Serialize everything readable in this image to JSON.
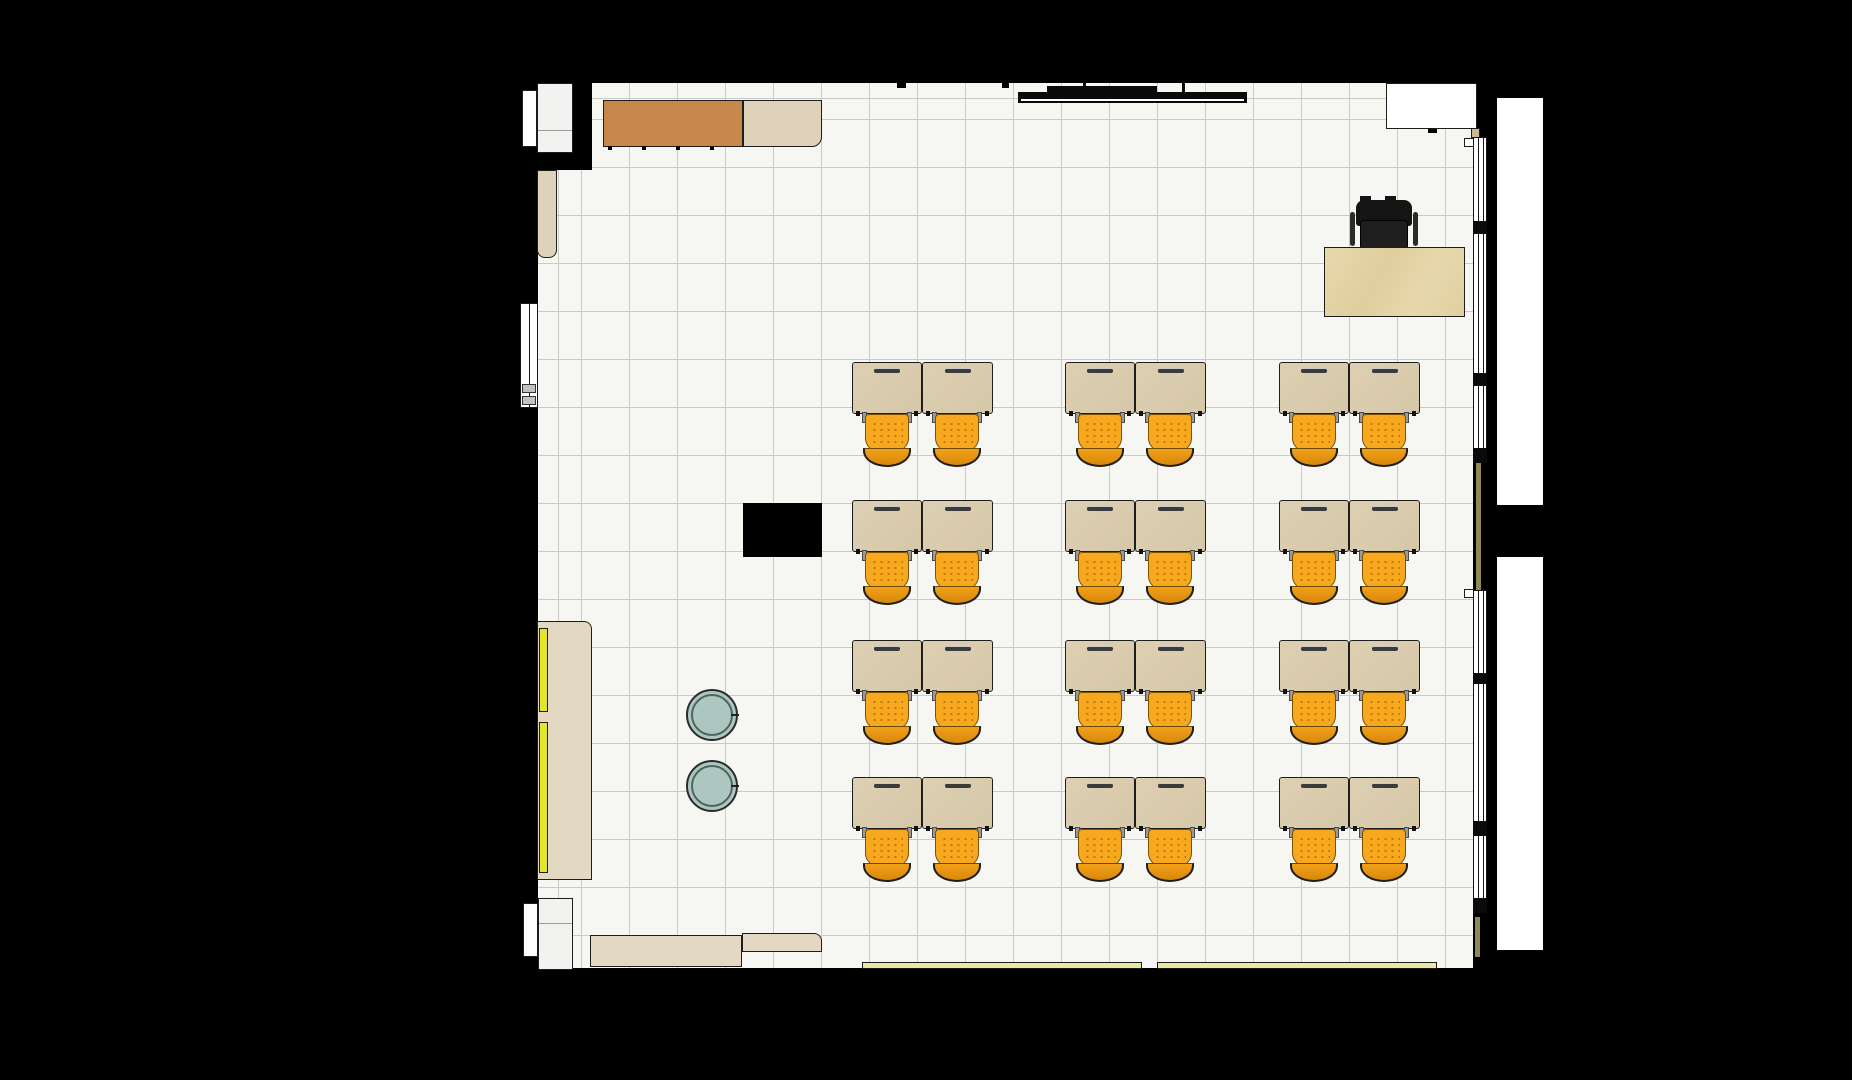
{
  "scene": {
    "width": 1852,
    "height": 1080,
    "background": "#000000",
    "description": "top-down classroom floor plan render"
  },
  "palette": {
    "wall": "#000000",
    "floor": "#F6F6F3",
    "grid_line": "#CBCBC6",
    "line": "#1d1d1d",
    "desk_wood": "#DBCEAF",
    "cabinet_brown": "#C8874A",
    "cabinet_tan": "#DFD2BA",
    "cabinet_light": "#E3D8C2",
    "teacher_desk_wood": "#E7D8AC",
    "chair_orange": "#F7A81F",
    "chair_orange_dark": "#D8880A",
    "stool_teal": "#AEC6C0",
    "door_white": "#FFFFFF",
    "recess_white": "#F2F2F0",
    "strip_yellow": "#E3E52C",
    "strip_pale_yellow": "#ECE6A4",
    "strip_khaki": "#8F8A55",
    "hardware_gray": "#C2C2C2",
    "hinge_tan": "#C9B98F",
    "chair_black": "#141414"
  },
  "floor": {
    "x": 538,
    "y": 83,
    "w": 935,
    "h": 885,
    "tile_px": 48,
    "wall_patch_top_left": {
      "x": 538,
      "y": 83,
      "w": 54,
      "h": 87
    }
  },
  "furniture": {
    "student_desks": {
      "label": "double student desk with two orange chairs",
      "cols_x": [
        852,
        1065,
        1279
      ],
      "rows_y": [
        362,
        500,
        640,
        777
      ],
      "pair_w": 141,
      "desk_w": 70,
      "desk_h": 52,
      "chair_w": 48,
      "chair_h": 53,
      "chair_centers": [
        35,
        105
      ]
    },
    "teacher_desk": {
      "x": 1324,
      "y": 247,
      "w": 141,
      "h": 70
    },
    "teacher_chair": {
      "x": 1350,
      "y": 200,
      "w": 68,
      "h": 50
    },
    "stools": [
      {
        "x": 686,
        "y": 689,
        "d": 52
      },
      {
        "x": 686,
        "y": 760,
        "d": 52
      }
    ],
    "shapes": [
      {
        "name": "wall-column-block",
        "x": 743,
        "y": 503,
        "w": 79,
        "h": 54,
        "fill": "wall"
      },
      {
        "name": "cabinet-top-brown",
        "x": 603,
        "y": 100,
        "w": 140,
        "h": 47,
        "fill": "cabinet_brown",
        "border": true
      },
      {
        "name": "cabinet-top-tan",
        "x": 743,
        "y": 100,
        "w": 79,
        "h": 47,
        "fill": "cabinet_tan",
        "border": true,
        "radius": "0 0 10px 0"
      },
      {
        "name": "cabinet-left-upper",
        "x": 537,
        "y": 170,
        "w": 20,
        "h": 88,
        "fill": "cabinet_tan",
        "border": true,
        "radius": "0 0 8px 8px"
      },
      {
        "name": "cabinet-left-lower",
        "x": 537,
        "y": 621,
        "w": 55,
        "h": 259,
        "fill": "cabinet_light",
        "border": true,
        "radius": "0 8px 0 0"
      },
      {
        "name": "cabinet-door-strip",
        "x": 539,
        "y": 628,
        "w": 9,
        "h": 84,
        "fill": "strip_yellow",
        "border": true
      },
      {
        "name": "cabinet-door-strip",
        "x": 539,
        "y": 722,
        "w": 9,
        "h": 151,
        "fill": "strip_yellow",
        "border": true
      },
      {
        "name": "cabinet-bottom-left",
        "x": 590,
        "y": 935,
        "w": 152,
        "h": 32,
        "fill": "cabinet_light",
        "border": true
      },
      {
        "name": "cabinet-bottom-rounded",
        "x": 742,
        "y": 933,
        "w": 80,
        "h": 19,
        "fill": "cabinet_light",
        "border": true,
        "radius": "0 8px 0 0"
      },
      {
        "name": "bottom-wall-board-strip",
        "x": 862,
        "y": 962,
        "w": 280,
        "h": 7,
        "fill": "strip_pale_yellow",
        "border": true
      },
      {
        "name": "bottom-wall-board-strip",
        "x": 1157,
        "y": 962,
        "w": 280,
        "h": 7,
        "fill": "strip_pale_yellow",
        "border": true
      },
      {
        "name": "door-panel-top-left",
        "x": 522,
        "y": 90,
        "w": 15,
        "h": 57,
        "fill": "door_white",
        "border": true
      },
      {
        "name": "door-recess-top-left",
        "x": 537,
        "y": 83,
        "w": 36,
        "h": 70,
        "fill": "recess_white",
        "border": true
      },
      {
        "name": "door-recess-divider",
        "x": 538,
        "y": 130,
        "w": 34,
        "h": 1,
        "fill": "#9a9a9a"
      },
      {
        "name": "door-panel-bottom-left",
        "x": 523,
        "y": 903,
        "w": 15,
        "h": 54,
        "fill": "door_white",
        "border": true
      },
      {
        "name": "door-recess-bottom-left",
        "x": 538,
        "y": 898,
        "w": 35,
        "h": 72,
        "fill": "recess_white",
        "border": true
      },
      {
        "name": "door-recess-divider",
        "x": 539,
        "y": 923,
        "w": 33,
        "h": 1,
        "fill": "#9a9a9a"
      },
      {
        "name": "door-alcove-top-right",
        "x": 1386,
        "y": 83,
        "w": 91,
        "h": 46,
        "fill": "door_white",
        "border": true
      },
      {
        "name": "door-stop-nub",
        "x": 1428,
        "y": 129,
        "w": 9,
        "h": 4,
        "fill": "wall"
      },
      {
        "name": "whiteboard-plan-bar",
        "x": 1018,
        "y": 92,
        "w": 229,
        "h": 11,
        "fill": "#0a0a0a"
      },
      {
        "name": "whiteboard-tray-line",
        "x": 1021,
        "y": 99,
        "w": 223,
        "h": 2,
        "fill": "#ffffff"
      },
      {
        "name": "whiteboard-bracket",
        "x": 1047,
        "y": 86,
        "w": 110,
        "h": 6,
        "fill": "#0a0a0a"
      },
      {
        "name": "whiteboard-mount-tick",
        "x": 1083,
        "y": 83,
        "w": 3,
        "h": 9,
        "fill": "#0a0a0a"
      },
      {
        "name": "whiteboard-mount-tick",
        "x": 1182,
        "y": 83,
        "w": 3,
        "h": 9,
        "fill": "#0a0a0a"
      },
      {
        "name": "wall-joint-nub",
        "x": 897,
        "y": 83,
        "w": 9,
        "h": 5,
        "fill": "wall"
      },
      {
        "name": "wall-joint-nub",
        "x": 1002,
        "y": 83,
        "w": 7,
        "h": 5,
        "fill": "wall"
      },
      {
        "name": "window-hinge",
        "x": 1471,
        "y": 128,
        "w": 9,
        "h": 10,
        "fill": "hinge_tan",
        "border": true
      },
      {
        "name": "wall-panel-khaki",
        "x": 1476,
        "y": 462,
        "w": 5,
        "h": 128,
        "fill": "strip_khaki"
      },
      {
        "name": "wall-panel-khaki",
        "x": 1475,
        "y": 917,
        "w": 5,
        "h": 40,
        "fill": "strip_khaki"
      },
      {
        "name": "window-handle",
        "x": 1464,
        "y": 138,
        "w": 10,
        "h": 9,
        "fill": "door_white",
        "border": true
      },
      {
        "name": "window-handle",
        "x": 1464,
        "y": 589,
        "w": 10,
        "h": 9,
        "fill": "door_white",
        "border": true
      },
      {
        "name": "exterior-walkway",
        "x": 1497,
        "y": 98,
        "w": 46,
        "h": 407,
        "fill": "door_white"
      },
      {
        "name": "exterior-walkway",
        "x": 1497,
        "y": 557,
        "w": 46,
        "h": 393,
        "fill": "door_white"
      },
      {
        "name": "wall-pier-bulge",
        "x": 1481,
        "y": 505,
        "w": 64,
        "h": 52,
        "fill": "wall"
      }
    ],
    "left_window": {
      "x": 520,
      "y": 303,
      "w": 18,
      "h": 105,
      "handles": [
        {
          "ry": 80,
          "h": 9
        },
        {
          "ry": 92,
          "h": 9
        }
      ]
    },
    "right_windows": [
      {
        "name": "window-band-upper",
        "x": 1473,
        "y": 137,
        "w": 14,
        "h": 325,
        "mullions": [
          {
            "ry": 83,
            "h": 13
          },
          {
            "ry": 235,
            "h": 13
          },
          {
            "ry": 310,
            "h": 15
          }
        ]
      },
      {
        "name": "window-band-lower",
        "x": 1473,
        "y": 590,
        "w": 14,
        "h": 322,
        "mullions": [
          {
            "ry": 82,
            "h": 11
          },
          {
            "ry": 230,
            "h": 15
          },
          {
            "ry": 307,
            "h": 15
          }
        ]
      }
    ],
    "counts": {
      "student_desk_pairs": 12,
      "student_chairs": 24,
      "stools": 2
    }
  }
}
